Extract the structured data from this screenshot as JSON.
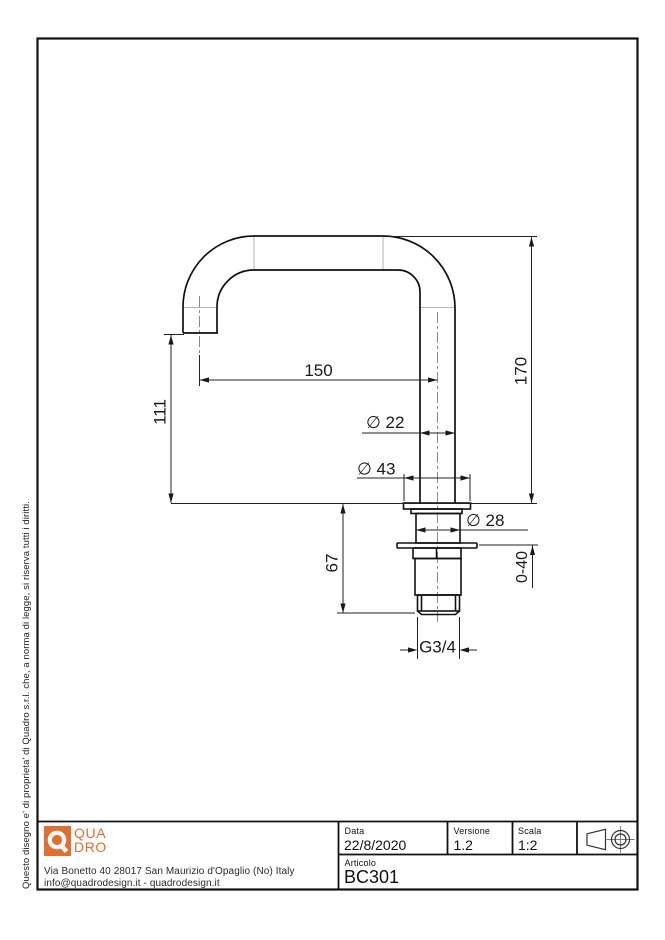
{
  "sheet": {
    "side_note": "Questo disegno e' di proprieta' di Quadro s.r.l. che, a norma di legge, si riserva tutti i diritti."
  },
  "branding": {
    "logo_letter": "Q",
    "logo_line1": "QUA",
    "logo_line2": "DRO",
    "brand_color": "#e46f2d",
    "address": "Via Bonetto 40  28017 San Maurizio d'Opaglio (No) Italy",
    "contacts": "info@quadrodesign.it  -  quadrodesign.it"
  },
  "title_block": {
    "date_label": "Data",
    "date_value": "22/8/2020",
    "version_label": "Versione",
    "version_value": "1.2",
    "scale_label": "Scala",
    "scale_value": "1:2",
    "article_label": "Articolo",
    "article_value": "BC301"
  },
  "drawing": {
    "part": "faucet spout side view",
    "dims": {
      "spout_reach": "150",
      "total_height": "170",
      "outlet_height": "111",
      "tube_diameter": "∅ 22",
      "flange_diameter": "∅ 43",
      "body_diameter": "∅ 28",
      "shank_length": "67",
      "clamp_range": "0-40",
      "thread": "G3/4"
    }
  }
}
